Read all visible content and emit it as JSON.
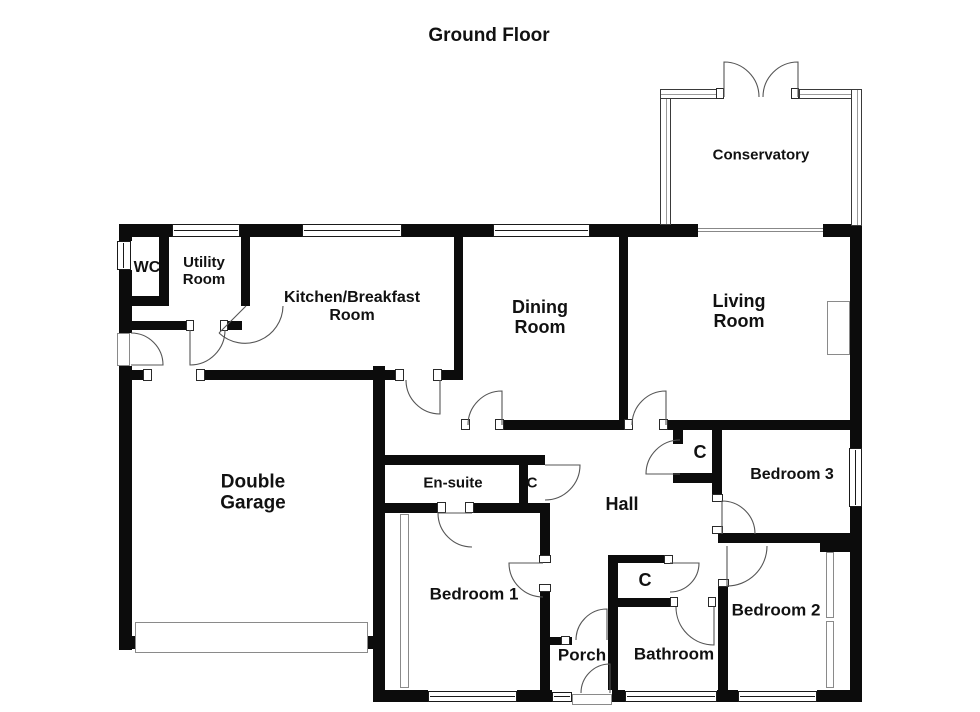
{
  "title": "Ground Floor",
  "colors": {
    "wall": "#0c0c0c",
    "door_arc": "#555555",
    "background": "#ffffff",
    "text": "#111111"
  },
  "rooms": [
    {
      "id": "wc",
      "label": "WC"
    },
    {
      "id": "utility",
      "label": "Utility\nRoom"
    },
    {
      "id": "kitchen",
      "label": "Kitchen/Breakfast\nRoom"
    },
    {
      "id": "dining",
      "label": "Dining\nRoom"
    },
    {
      "id": "living",
      "label": "Living\nRoom"
    },
    {
      "id": "conservatory",
      "label": "Conservatory"
    },
    {
      "id": "garage",
      "label": "Double\nGarage"
    },
    {
      "id": "ensuite",
      "label": "En-suite"
    },
    {
      "id": "hall",
      "label": "Hall"
    },
    {
      "id": "bedroom1",
      "label": "Bedroom 1"
    },
    {
      "id": "bedroom2",
      "label": "Bedroom 2"
    },
    {
      "id": "bedroom3",
      "label": "Bedroom 3"
    },
    {
      "id": "bathroom",
      "label": "Bathroom"
    },
    {
      "id": "porch",
      "label": "Porch"
    },
    {
      "id": "closet_ensuite",
      "label": "C"
    },
    {
      "id": "closet_hall",
      "label": "C"
    },
    {
      "id": "closet_bathroom",
      "label": "C"
    }
  ]
}
